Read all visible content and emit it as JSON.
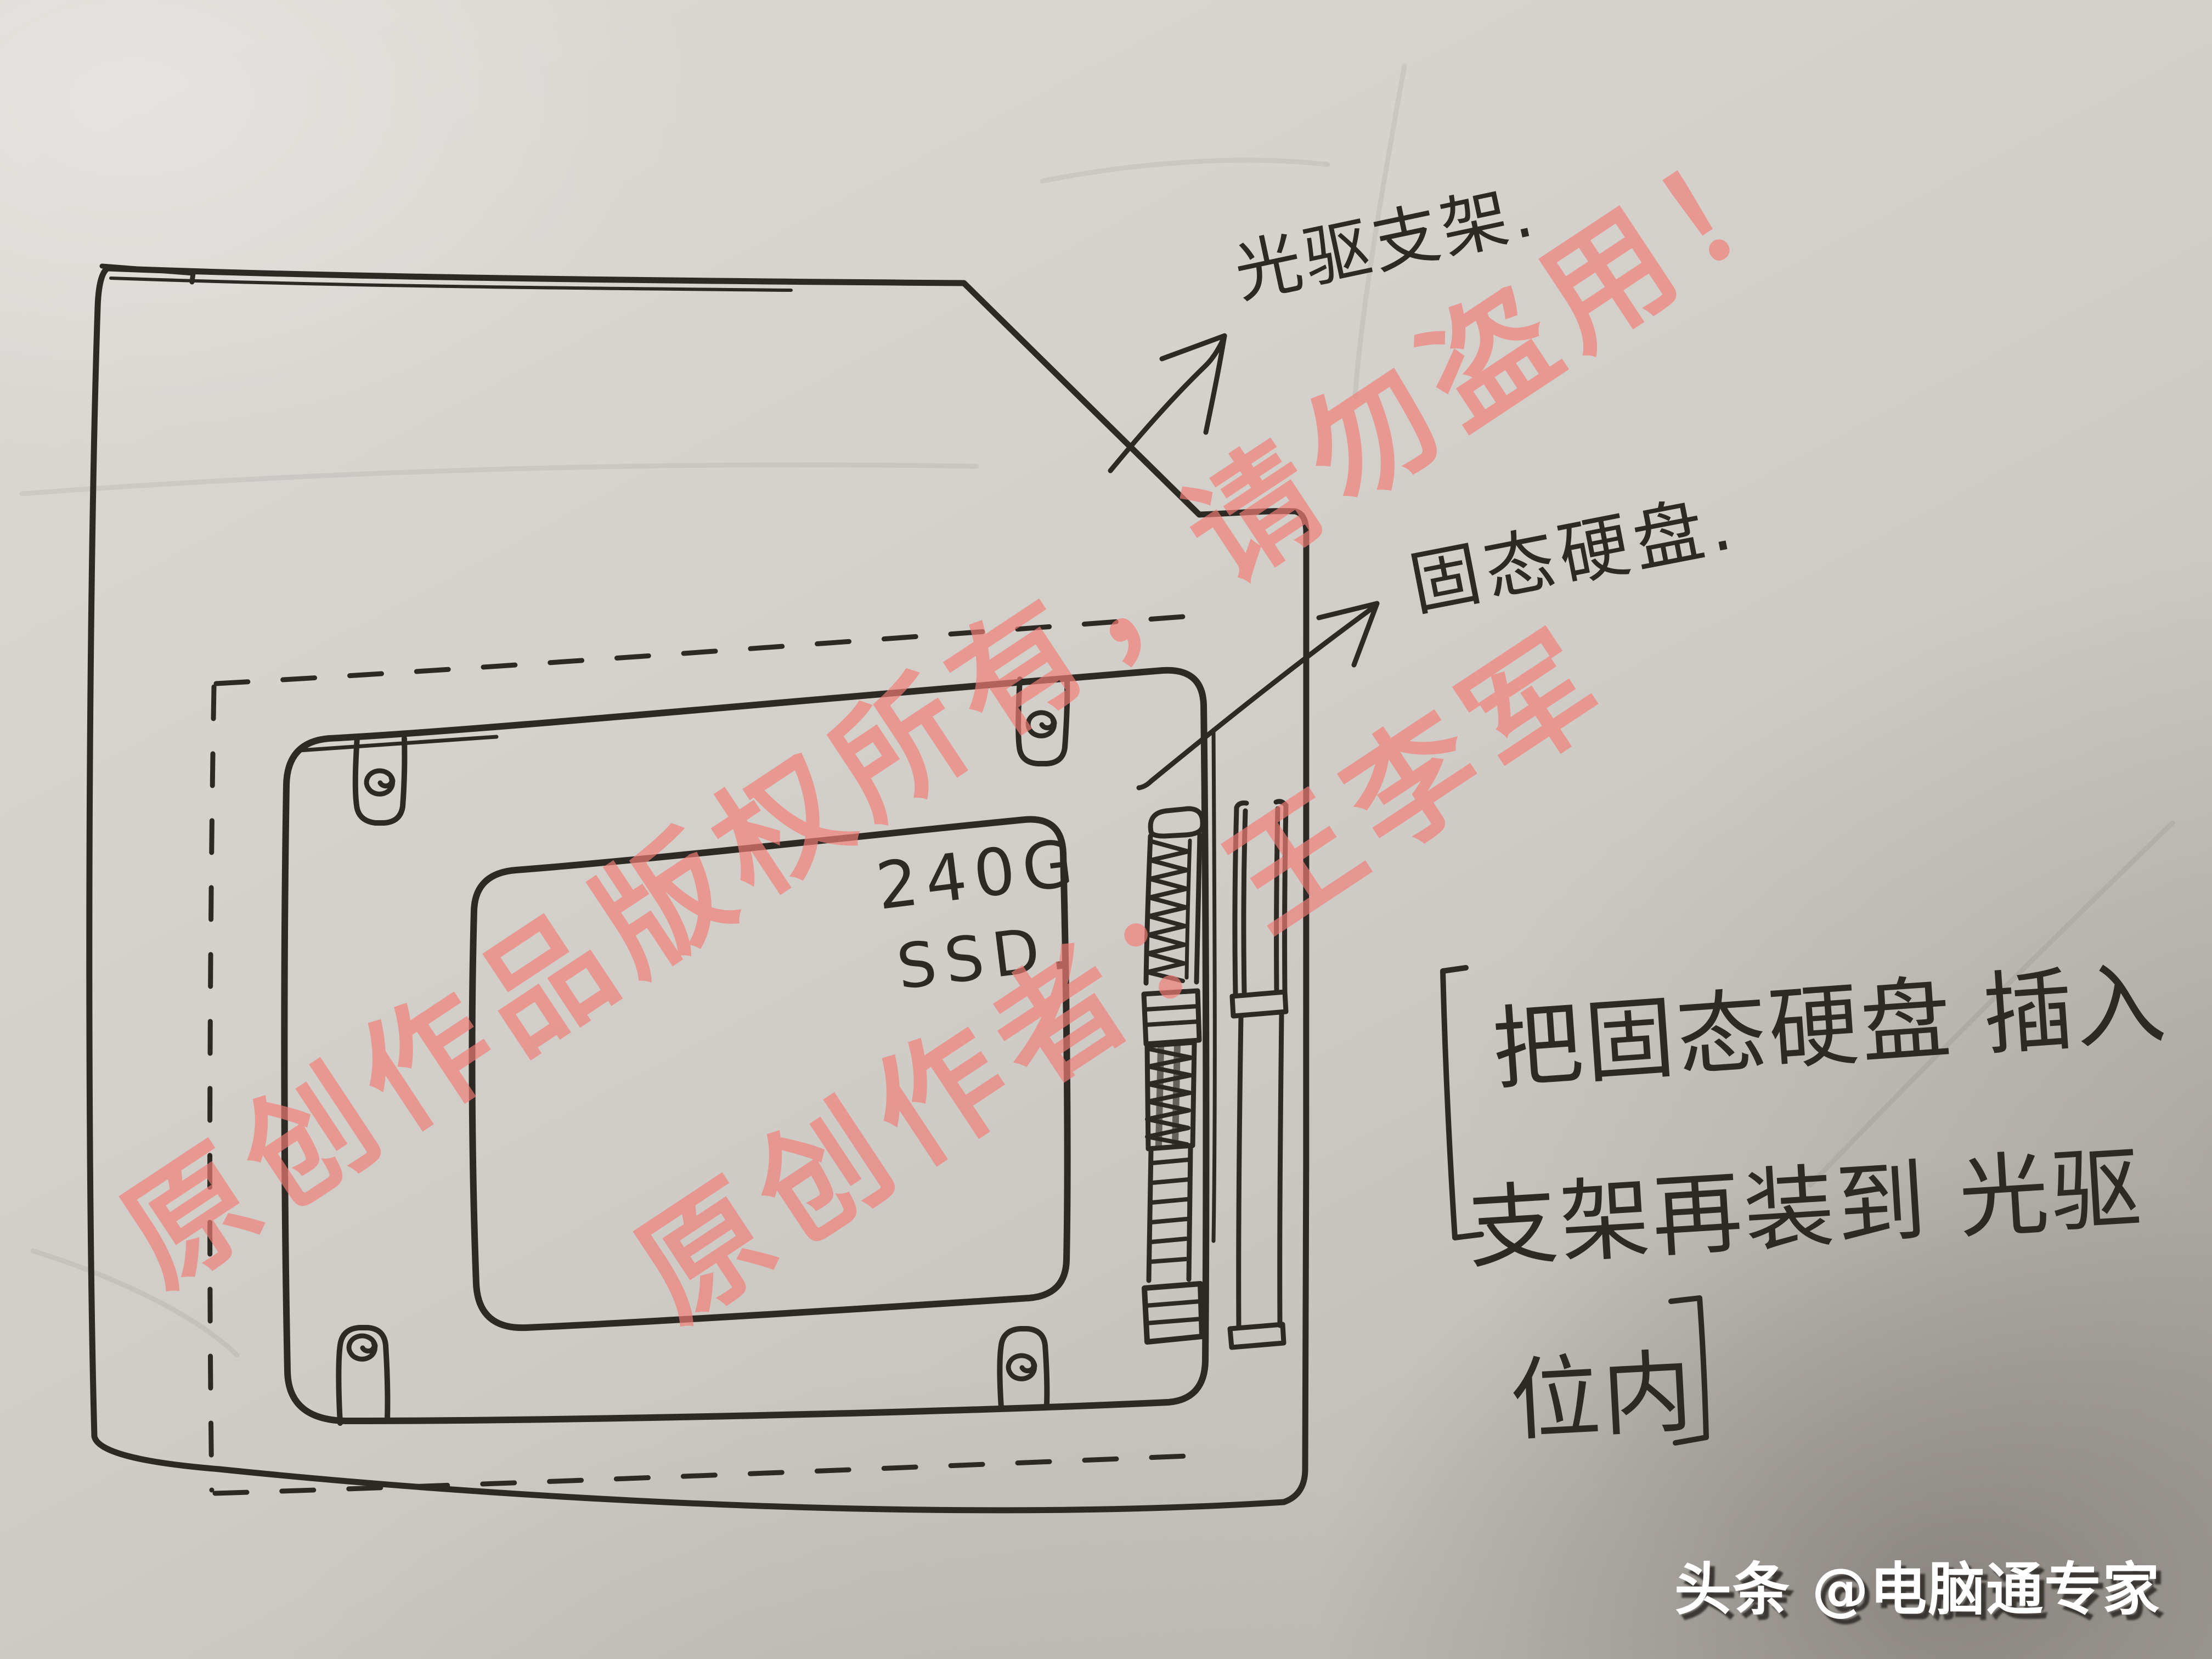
{
  "diagram": {
    "ssd_label_line1": "240G",
    "ssd_label_line2": "SSD.",
    "callout_bracket": "光驱支架.",
    "callout_ssd": "固态硬盘.",
    "note": {
      "line1": "把固态硬盘 插入",
      "line2": "支架再装到 光驱",
      "line3": "位内"
    }
  },
  "watermark": {
    "line1": "原创作品版权所有，请勿盗用！",
    "line2": "原创作者：王李军",
    "color": "#f27e76"
  },
  "byline": {
    "text": "头条 @电脑通专家",
    "color": "#ffffff"
  },
  "colors": {
    "paper": "#d2cfca",
    "ink": "#2d2a25"
  }
}
